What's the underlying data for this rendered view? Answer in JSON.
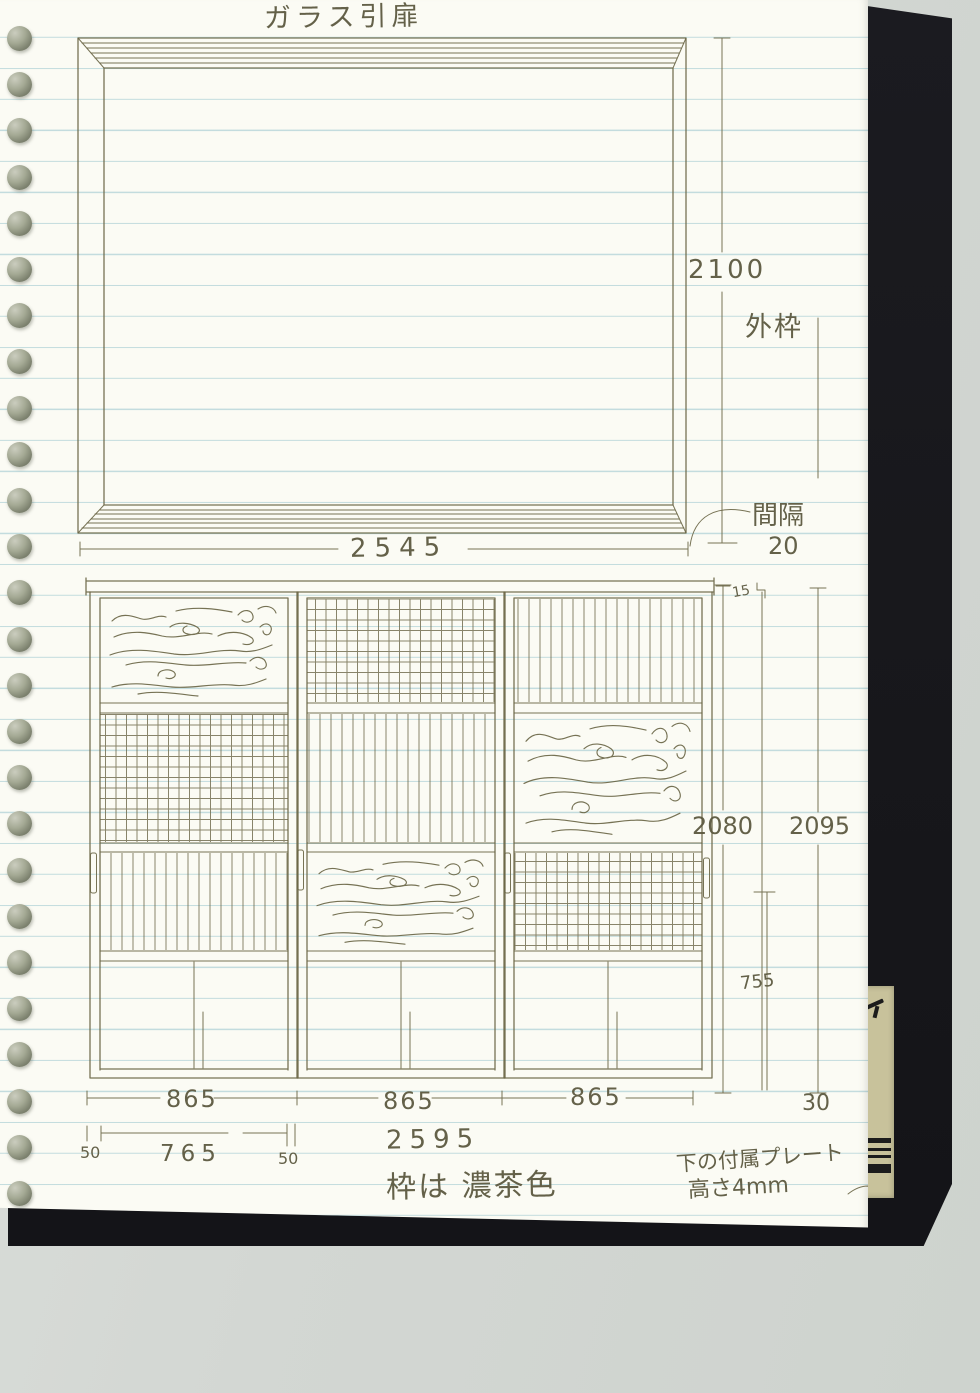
{
  "notebook": {
    "title": "ガラス引扉",
    "binding": {
      "hole_count": 26
    }
  },
  "top_drawing": {
    "height_dim": "2100",
    "outer_frame_label": "外枠",
    "gap_label": "間隔",
    "gap_value": "20",
    "width_dim": "2545"
  },
  "lower_drawing": {
    "top_inset_dim": "15",
    "inner_height_dim": "2080",
    "outer_height_dim": "2095",
    "handle_height_dim": "755",
    "door_widths": [
      "865",
      "865",
      "865"
    ],
    "right_gap_dim": "30",
    "left_margin_dim": "50",
    "glass_width_dim": "765",
    "right_margin_dim": "50",
    "total_width_dim": "2595",
    "doors": [
      {
        "name": "left-door",
        "sections": [
          "wood-grain-glass",
          "grid-glass",
          "vertical-line-glass",
          "plain-panel"
        ]
      },
      {
        "name": "middle-door",
        "sections": [
          "grid-glass",
          "vertical-line-glass",
          "wood-grain-glass",
          "plain-panel"
        ]
      },
      {
        "name": "right-door",
        "sections": [
          "vertical-line-glass",
          "wood-grain-glass",
          "grid-glass",
          "plain-panel"
        ]
      }
    ]
  },
  "notes": {
    "frame_color": "枠は 濃茶色",
    "plate_line1": "下の付属プレート",
    "plate_line2": "高さ4mm"
  },
  "colors": {
    "ink": "#6b6747",
    "page": "#fbfbf4",
    "ruled_line": "#8cbec8",
    "cover": "#17171b",
    "scanner_bg": "#d3d7d3",
    "binder_ring": "#a4a994",
    "label": "#c8c29b"
  }
}
